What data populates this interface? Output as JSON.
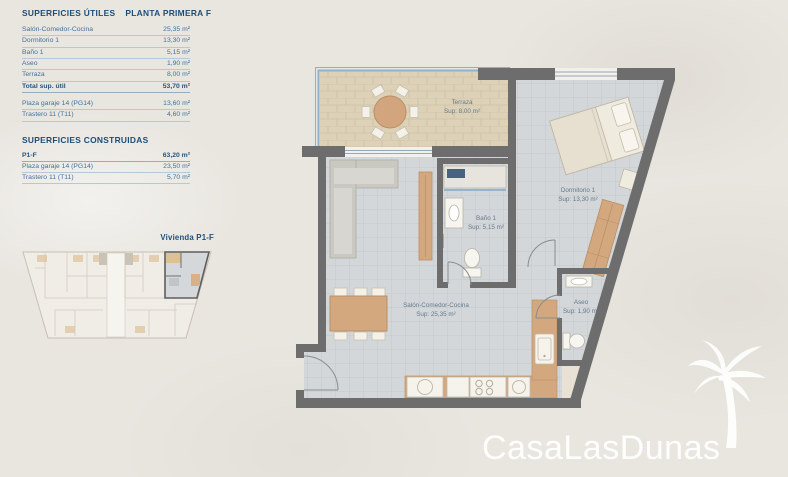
{
  "panel": {
    "utiles": {
      "title": "SUPERFICIES ÚTILES",
      "plant": "PLANTA PRIMERA F",
      "rows": [
        {
          "label": "Salón-Comedor-Cocina",
          "value": "25,35 m²"
        },
        {
          "label": "Dormitorio 1",
          "value": "13,30 m²"
        },
        {
          "label": "Baño 1",
          "value": "5,15 m²"
        },
        {
          "label": "Aseo",
          "value": "1,90 m²"
        },
        {
          "label": "Terraza",
          "value": "8,00 m²"
        }
      ],
      "total": {
        "label": "Total sup. útil",
        "value": "53,70 m²"
      },
      "annex": [
        {
          "label": "Plaza garaje 14 (PG14)",
          "value": "13,60 m²"
        },
        {
          "label": "Trastero 11 (T11)",
          "value": "4,60 m²"
        }
      ]
    },
    "construidas": {
      "title": "SUPERFICIES CONSTRUIDAS",
      "rows": [
        {
          "label": "P1-F",
          "value": "63,20 m²"
        },
        {
          "label": "Plaza garaje 14 (PG14)",
          "value": "23,50 m²"
        },
        {
          "label": "Trastero 11 (T11)",
          "value": "5,70 m²"
        }
      ]
    }
  },
  "mini_plan": {
    "label": "Vivienda P1-F"
  },
  "plan": {
    "rooms": {
      "terraza": {
        "name": "Terraza",
        "sup": "Sup: 8,00 m²"
      },
      "dormitorio": {
        "name": "Dormitorio 1",
        "sup": "Sup: 13,30 m²"
      },
      "bano": {
        "name": "Baño 1",
        "sup": "Sup: 5,15 m²"
      },
      "salon": {
        "name": "Salón-Comedor-Cocina",
        "sup": "Sup: 25,35 m²"
      },
      "aseo": {
        "name": "Aseo",
        "sup": "Sup: 1,90 m²"
      }
    }
  },
  "logo": {
    "text": "CasaLasDunas"
  },
  "colors": {
    "accent_navy": "#1c4d78",
    "table_text": "#41719c",
    "wall": "#6d6d6d",
    "wood": "#d4a87e",
    "terrace_tile": "#ddd2b8",
    "floor_tile": "#d3d7da",
    "railing_blue": "#8fb3cd",
    "logo_white": "#ffffff"
  }
}
